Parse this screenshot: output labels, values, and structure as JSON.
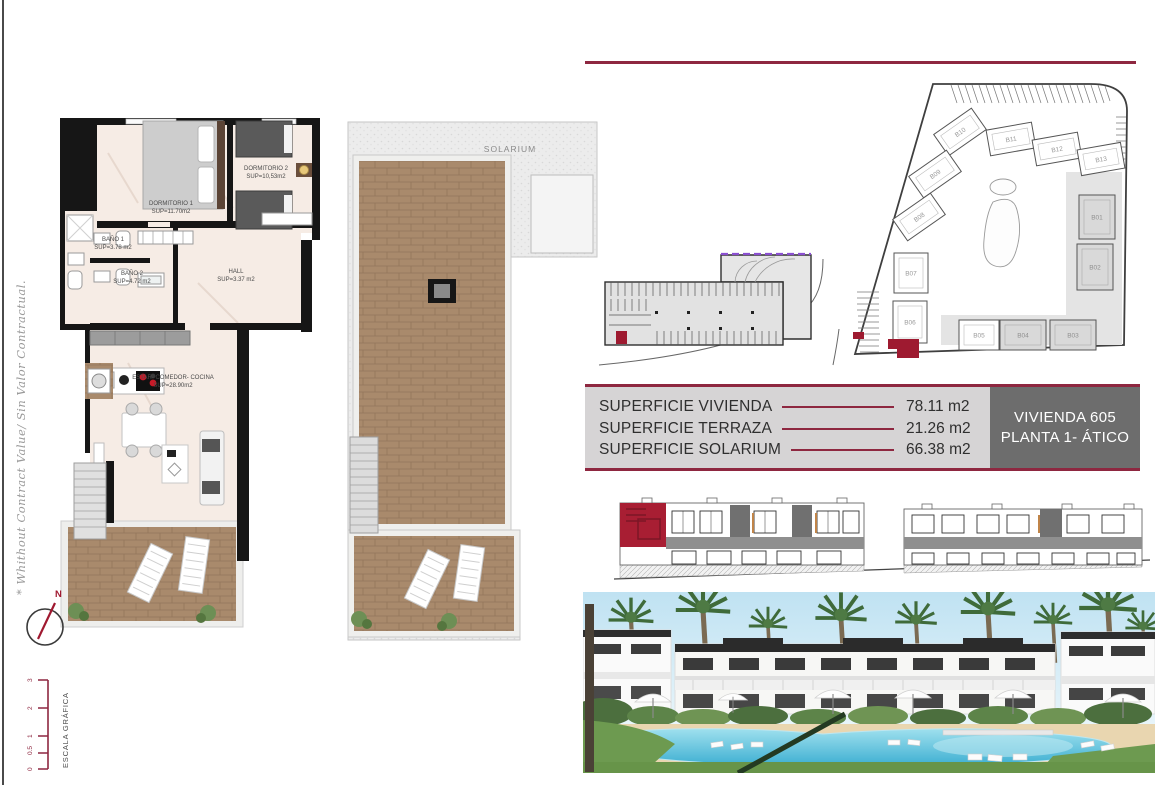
{
  "sheet": {
    "note_vertical": "* Whithout Contract Value/ Sin Valor Contractual.",
    "compass": {
      "label": "N"
    },
    "scale_bar": {
      "title": "ESCALA GRÁFICA",
      "ticks": [
        "0",
        "0.5",
        "1",
        "2",
        "3"
      ]
    }
  },
  "apartment_plan": {
    "rooms": {
      "dormitorio1": {
        "name": "DORMITORIO 1",
        "sup": "SUP=11.70m2"
      },
      "dormitorio2": {
        "name": "DORMITORIO 2",
        "sup": "SUP=10,53m2"
      },
      "bano1": {
        "name": "BAÑO 1",
        "sup": "SUP=3.78 m2"
      },
      "bano2": {
        "name": "BAÑO 2",
        "sup": "SUP=4.72 m2"
      },
      "hall": {
        "name": "HALL",
        "sup": "SUP=3.37 m2"
      },
      "estar": {
        "name": "ESTAR- COMEDOR- COCINA",
        "sup": "SUP=28.90m2"
      }
    }
  },
  "solarium_plan": {
    "label": "SOLARIUM"
  },
  "site_plan": {
    "buildings": [
      "B01",
      "B02",
      "B03",
      "B04",
      "B05",
      "B06",
      "B07",
      "B08",
      "B09",
      "B10",
      "B11",
      "B12",
      "B13"
    ]
  },
  "summary_table": {
    "rows": [
      {
        "label": "SUPERFICIE VIVIENDA",
        "value": "78.11 m2"
      },
      {
        "label": "SUPERFICIE TERRAZA",
        "value": "21.26 m2"
      },
      {
        "label": "SUPERFICIE SOLARIUM",
        "value": "66.38 m2"
      }
    ]
  },
  "unit_box": {
    "line1": "VIVIENDA 605",
    "line2": "PLANTA 1- ÁTICO"
  },
  "colors": {
    "accent_maroon": "#8e2740",
    "highlight_red": "#a01930",
    "unit_box_gray": "#6d6d6d"
  }
}
